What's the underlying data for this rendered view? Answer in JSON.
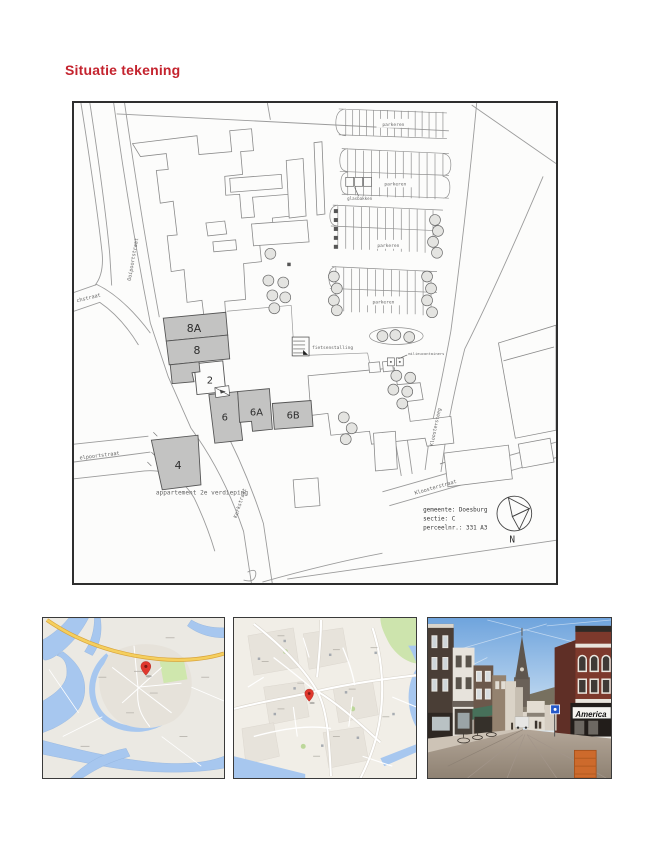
{
  "title": "Situatie tekening",
  "plan": {
    "streets": {
      "ooipoortstraat": "Ooipoortstraat",
      "chstraat": "chstraat",
      "elpoortstraat": "elpoortstraat",
      "kerkstraat": "Kerkstraat",
      "kloostersteeg": "Kloostersteeg",
      "kloosterstraat": "Kloosterstraat"
    },
    "plots": {
      "p8a": "8A",
      "p8": "8",
      "p2": "2",
      "p6": "6",
      "p6a": "6A",
      "p6b": "6B",
      "p4": "4"
    },
    "annotations": {
      "parkeren": "parkeren",
      "glasbakken": "glasbakken",
      "fietsenstalling": "fietsenstalling",
      "milieucontainers": "milieucontainers",
      "apartment": "appartement 2e verdieping"
    },
    "cadastre": {
      "line1": "gemeente: Doesburg",
      "line2": "sectie: C",
      "line3": "perceelnr.: 331  A3",
      "north": "N"
    }
  },
  "photos": {
    "street_view_sign": "America"
  }
}
